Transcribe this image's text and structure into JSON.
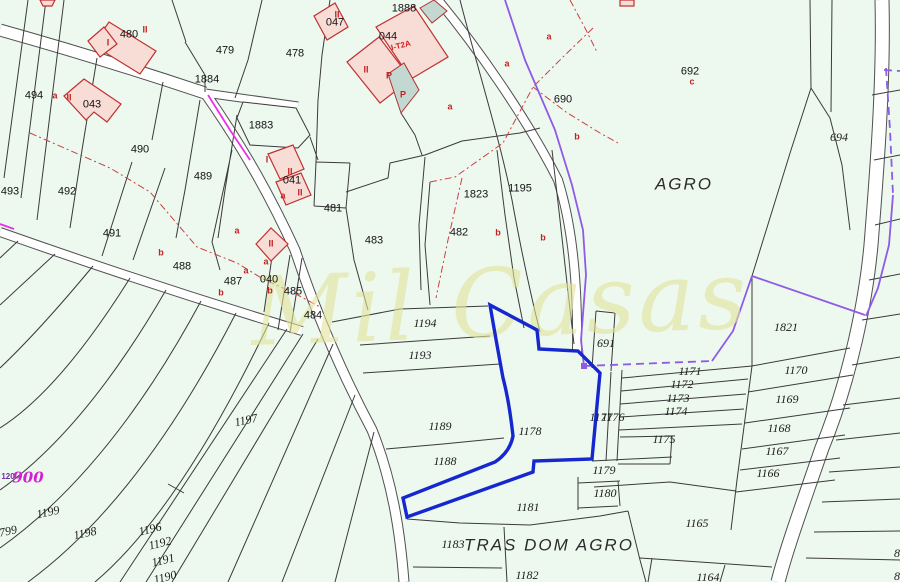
{
  "map": {
    "watermark": "Mil Casas",
    "colors": {
      "land": "#edf8ef",
      "road_fill": "#ffffff",
      "parcel_line": "#3a3a3a",
      "building_fill": "#f8dcd6",
      "building_stroke": "#c03030",
      "annex_fill": "#c2d8d0",
      "highlight_parcel": "#1527cf",
      "boundary_purple": "#8f5ae6",
      "boundary_magenta": "#e832e8",
      "red_overlay": "#cc4040",
      "watermark_color": "#e3e39b"
    },
    "selected_parcel": "1178",
    "place_names": [
      "AGRO",
      "TRAS DOM AGRO"
    ],
    "labels": [
      {
        "t": "480",
        "x": 129,
        "y": 35,
        "c": "n"
      },
      {
        "t": "479",
        "x": 225,
        "y": 51,
        "c": "n"
      },
      {
        "t": "478",
        "x": 295,
        "y": 54,
        "c": "n"
      },
      {
        "t": "1884",
        "x": 207,
        "y": 80,
        "c": "n"
      },
      {
        "t": "1883",
        "x": 261,
        "y": 126,
        "c": "n"
      },
      {
        "t": "047",
        "x": 335,
        "y": 23,
        "c": "n"
      },
      {
        "t": "1888",
        "x": 404,
        "y": 9,
        "c": "n"
      },
      {
        "t": "044",
        "x": 388,
        "y": 37,
        "c": "n"
      },
      {
        "t": "043",
        "x": 92,
        "y": 105,
        "c": "n"
      },
      {
        "t": "494",
        "x": 34,
        "y": 96,
        "c": "n"
      },
      {
        "t": "490",
        "x": 140,
        "y": 150,
        "c": "n"
      },
      {
        "t": "489",
        "x": 203,
        "y": 177,
        "c": "n"
      },
      {
        "t": "492",
        "x": 67,
        "y": 192,
        "c": "n"
      },
      {
        "t": "493",
        "x": 10,
        "y": 192,
        "c": "n"
      },
      {
        "t": "491",
        "x": 112,
        "y": 234,
        "c": "n"
      },
      {
        "t": "488",
        "x": 182,
        "y": 267,
        "c": "n"
      },
      {
        "t": "487",
        "x": 233,
        "y": 282,
        "c": "n"
      },
      {
        "t": "040",
        "x": 269,
        "y": 280,
        "c": "n"
      },
      {
        "t": "041",
        "x": 292,
        "y": 181,
        "c": "n"
      },
      {
        "t": "485",
        "x": 293,
        "y": 292,
        "c": "n"
      },
      {
        "t": "484",
        "x": 313,
        "y": 316,
        "c": "n"
      },
      {
        "t": "481",
        "x": 333,
        "y": 209,
        "c": "n"
      },
      {
        "t": "483",
        "x": 374,
        "y": 241,
        "c": "n"
      },
      {
        "t": "482",
        "x": 459,
        "y": 233,
        "c": "n"
      },
      {
        "t": "1823",
        "x": 476,
        "y": 195,
        "c": "n"
      },
      {
        "t": "1195",
        "x": 520,
        "y": 189,
        "c": "n"
      },
      {
        "t": "690",
        "x": 563,
        "y": 100,
        "c": "n"
      },
      {
        "t": "692",
        "x": 690,
        "y": 72,
        "c": "n"
      },
      {
        "t": "694",
        "x": 839,
        "y": 137,
        "c": "i"
      },
      {
        "t": "1821",
        "x": 786,
        "y": 327,
        "c": "i"
      },
      {
        "t": "691",
        "x": 606,
        "y": 343,
        "c": "i"
      },
      {
        "t": "1171",
        "x": 690,
        "y": 371,
        "c": "i"
      },
      {
        "t": "1172",
        "x": 682,
        "y": 384,
        "c": "i"
      },
      {
        "t": "1173",
        "x": 678,
        "y": 398,
        "c": "i"
      },
      {
        "t": "1174",
        "x": 676,
        "y": 411,
        "c": "i"
      },
      {
        "t": "1175",
        "x": 664,
        "y": 439,
        "c": "i"
      },
      {
        "t": "1170",
        "x": 796,
        "y": 370,
        "c": "i"
      },
      {
        "t": "1169",
        "x": 787,
        "y": 399,
        "c": "i"
      },
      {
        "t": "1168",
        "x": 779,
        "y": 428,
        "c": "i"
      },
      {
        "t": "1167",
        "x": 777,
        "y": 451,
        "c": "i"
      },
      {
        "t": "1166",
        "x": 768,
        "y": 473,
        "c": "i"
      },
      {
        "t": "1165",
        "x": 697,
        "y": 523,
        "c": "i"
      },
      {
        "t": "1164",
        "x": 708,
        "y": 577,
        "c": "i"
      },
      {
        "t": "1179",
        "x": 604,
        "y": 470,
        "c": "i"
      },
      {
        "t": "1180",
        "x": 605,
        "y": 493,
        "c": "i"
      },
      {
        "t": "1181",
        "x": 528,
        "y": 507,
        "c": "i"
      },
      {
        "t": "1183",
        "x": 453,
        "y": 544,
        "c": "i"
      },
      {
        "t": "1182",
        "x": 527,
        "y": 575,
        "c": "i"
      },
      {
        "t": "1178",
        "x": 530,
        "y": 431,
        "c": "i"
      },
      {
        "t": "1188",
        "x": 445,
        "y": 461,
        "c": "i"
      },
      {
        "t": "1189",
        "x": 440,
        "y": 426,
        "c": "i"
      },
      {
        "t": "1193",
        "x": 420,
        "y": 355,
        "c": "i"
      },
      {
        "t": "1194",
        "x": 425,
        "y": 323,
        "c": "i"
      },
      {
        "t": "1177",
        "x": 601,
        "y": 417,
        "c": "i"
      },
      {
        "t": "1176",
        "x": 613,
        "y": 417,
        "c": "i"
      },
      {
        "t": "1197",
        "x": 246,
        "y": 420,
        "c": "i",
        "rot": -12
      },
      {
        "t": "1199",
        "x": 48,
        "y": 512,
        "c": "i",
        "rot": -12
      },
      {
        "t": "1198",
        "x": 85,
        "y": 533,
        "c": "i",
        "rot": -12
      },
      {
        "t": "1196",
        "x": 150,
        "y": 529,
        "c": "i",
        "rot": -14
      },
      {
        "t": "1192",
        "x": 160,
        "y": 543,
        "c": "i",
        "rot": -14
      },
      {
        "t": "1191",
        "x": 163,
        "y": 560,
        "c": "i",
        "rot": -14
      },
      {
        "t": "1190",
        "x": 165,
        "y": 577,
        "c": "i",
        "rot": -14
      },
      {
        "t": "799",
        "x": 8,
        "y": 531,
        "c": "i",
        "rot": -12
      },
      {
        "t": "8",
        "x": 897,
        "y": 553,
        "c": "i"
      },
      {
        "t": "8",
        "x": 897,
        "y": 576,
        "c": "i"
      },
      {
        "t": "a",
        "x": 55,
        "y": 96,
        "c": "r"
      },
      {
        "t": "II",
        "x": 69,
        "y": 98,
        "c": "r"
      },
      {
        "t": "I",
        "x": 108,
        "y": 43,
        "c": "r"
      },
      {
        "t": "II",
        "x": 145,
        "y": 30,
        "c": "r"
      },
      {
        "t": "II",
        "x": 337,
        "y": 15,
        "c": "r"
      },
      {
        "t": "II",
        "x": 366,
        "y": 70,
        "c": "r"
      },
      {
        "t": "P",
        "x": 389,
        "y": 76,
        "c": "r"
      },
      {
        "t": "P",
        "x": 403,
        "y": 95,
        "c": "r"
      },
      {
        "t": "I",
        "x": 267,
        "y": 160,
        "c": "r"
      },
      {
        "t": "II",
        "x": 290,
        "y": 172,
        "c": "r"
      },
      {
        "t": "II",
        "x": 300,
        "y": 193,
        "c": "r"
      },
      {
        "t": "a",
        "x": 283,
        "y": 196,
        "c": "r"
      },
      {
        "t": "II",
        "x": 271,
        "y": 244,
        "c": "r"
      },
      {
        "t": "a",
        "x": 266,
        "y": 262,
        "c": "r"
      },
      {
        "t": "a",
        "x": 237,
        "y": 231,
        "c": "r"
      },
      {
        "t": "a",
        "x": 246,
        "y": 271,
        "c": "r"
      },
      {
        "t": "b",
        "x": 221,
        "y": 293,
        "c": "r"
      },
      {
        "t": "b",
        "x": 270,
        "y": 291,
        "c": "r"
      },
      {
        "t": "b",
        "x": 161,
        "y": 253,
        "c": "r"
      },
      {
        "t": "a",
        "x": 507,
        "y": 64,
        "c": "r"
      },
      {
        "t": "a",
        "x": 450,
        "y": 107,
        "c": "r"
      },
      {
        "t": "a",
        "x": 549,
        "y": 37,
        "c": "r"
      },
      {
        "t": "b",
        "x": 577,
        "y": 137,
        "c": "r"
      },
      {
        "t": "c",
        "x": 692,
        "y": 82,
        "c": "r"
      },
      {
        "t": "b",
        "x": 498,
        "y": 233,
        "c": "r"
      },
      {
        "t": "b",
        "x": 543,
        "y": 238,
        "c": "r"
      },
      {
        "t": "I-T2A",
        "x": 401,
        "y": 46,
        "c": "rs",
        "rot": -14
      },
      {
        "t": "AGRO",
        "x": 684,
        "y": 184,
        "c": "area"
      },
      {
        "t": "TRAS DOM AGRO",
        "x": 549,
        "y": 545,
        "c": "area"
      },
      {
        "t": "120",
        "x": 8,
        "y": 477,
        "c": "pm"
      },
      {
        "t": "900",
        "x": 28,
        "y": 478,
        "c": "pb"
      }
    ]
  }
}
